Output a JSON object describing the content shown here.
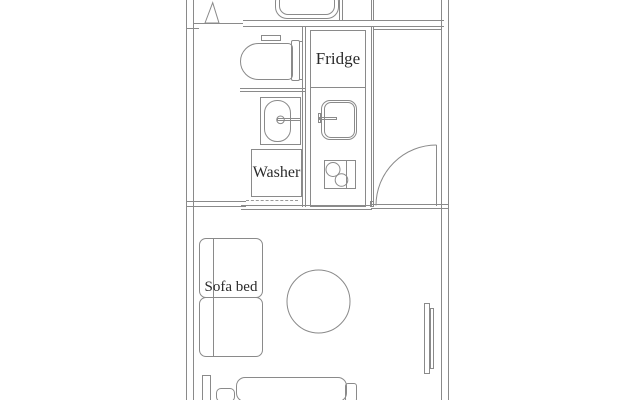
{
  "colors": {
    "background": "#ffffff",
    "wall_line": "#8a8a8a",
    "label_text": "#2b2b2b"
  },
  "labels": {
    "fridge": "Fridge",
    "washer": "Washer",
    "sofa_bed": "Sofa bed"
  },
  "fixtures": [
    "bathtub",
    "bathroom-door-triangle",
    "toilet",
    "washbasin",
    "washing-machine",
    "refrigerator",
    "kitchen-sink",
    "stove",
    "entry-door",
    "round-table",
    "sofa-bed",
    "bed",
    "window-board"
  ]
}
